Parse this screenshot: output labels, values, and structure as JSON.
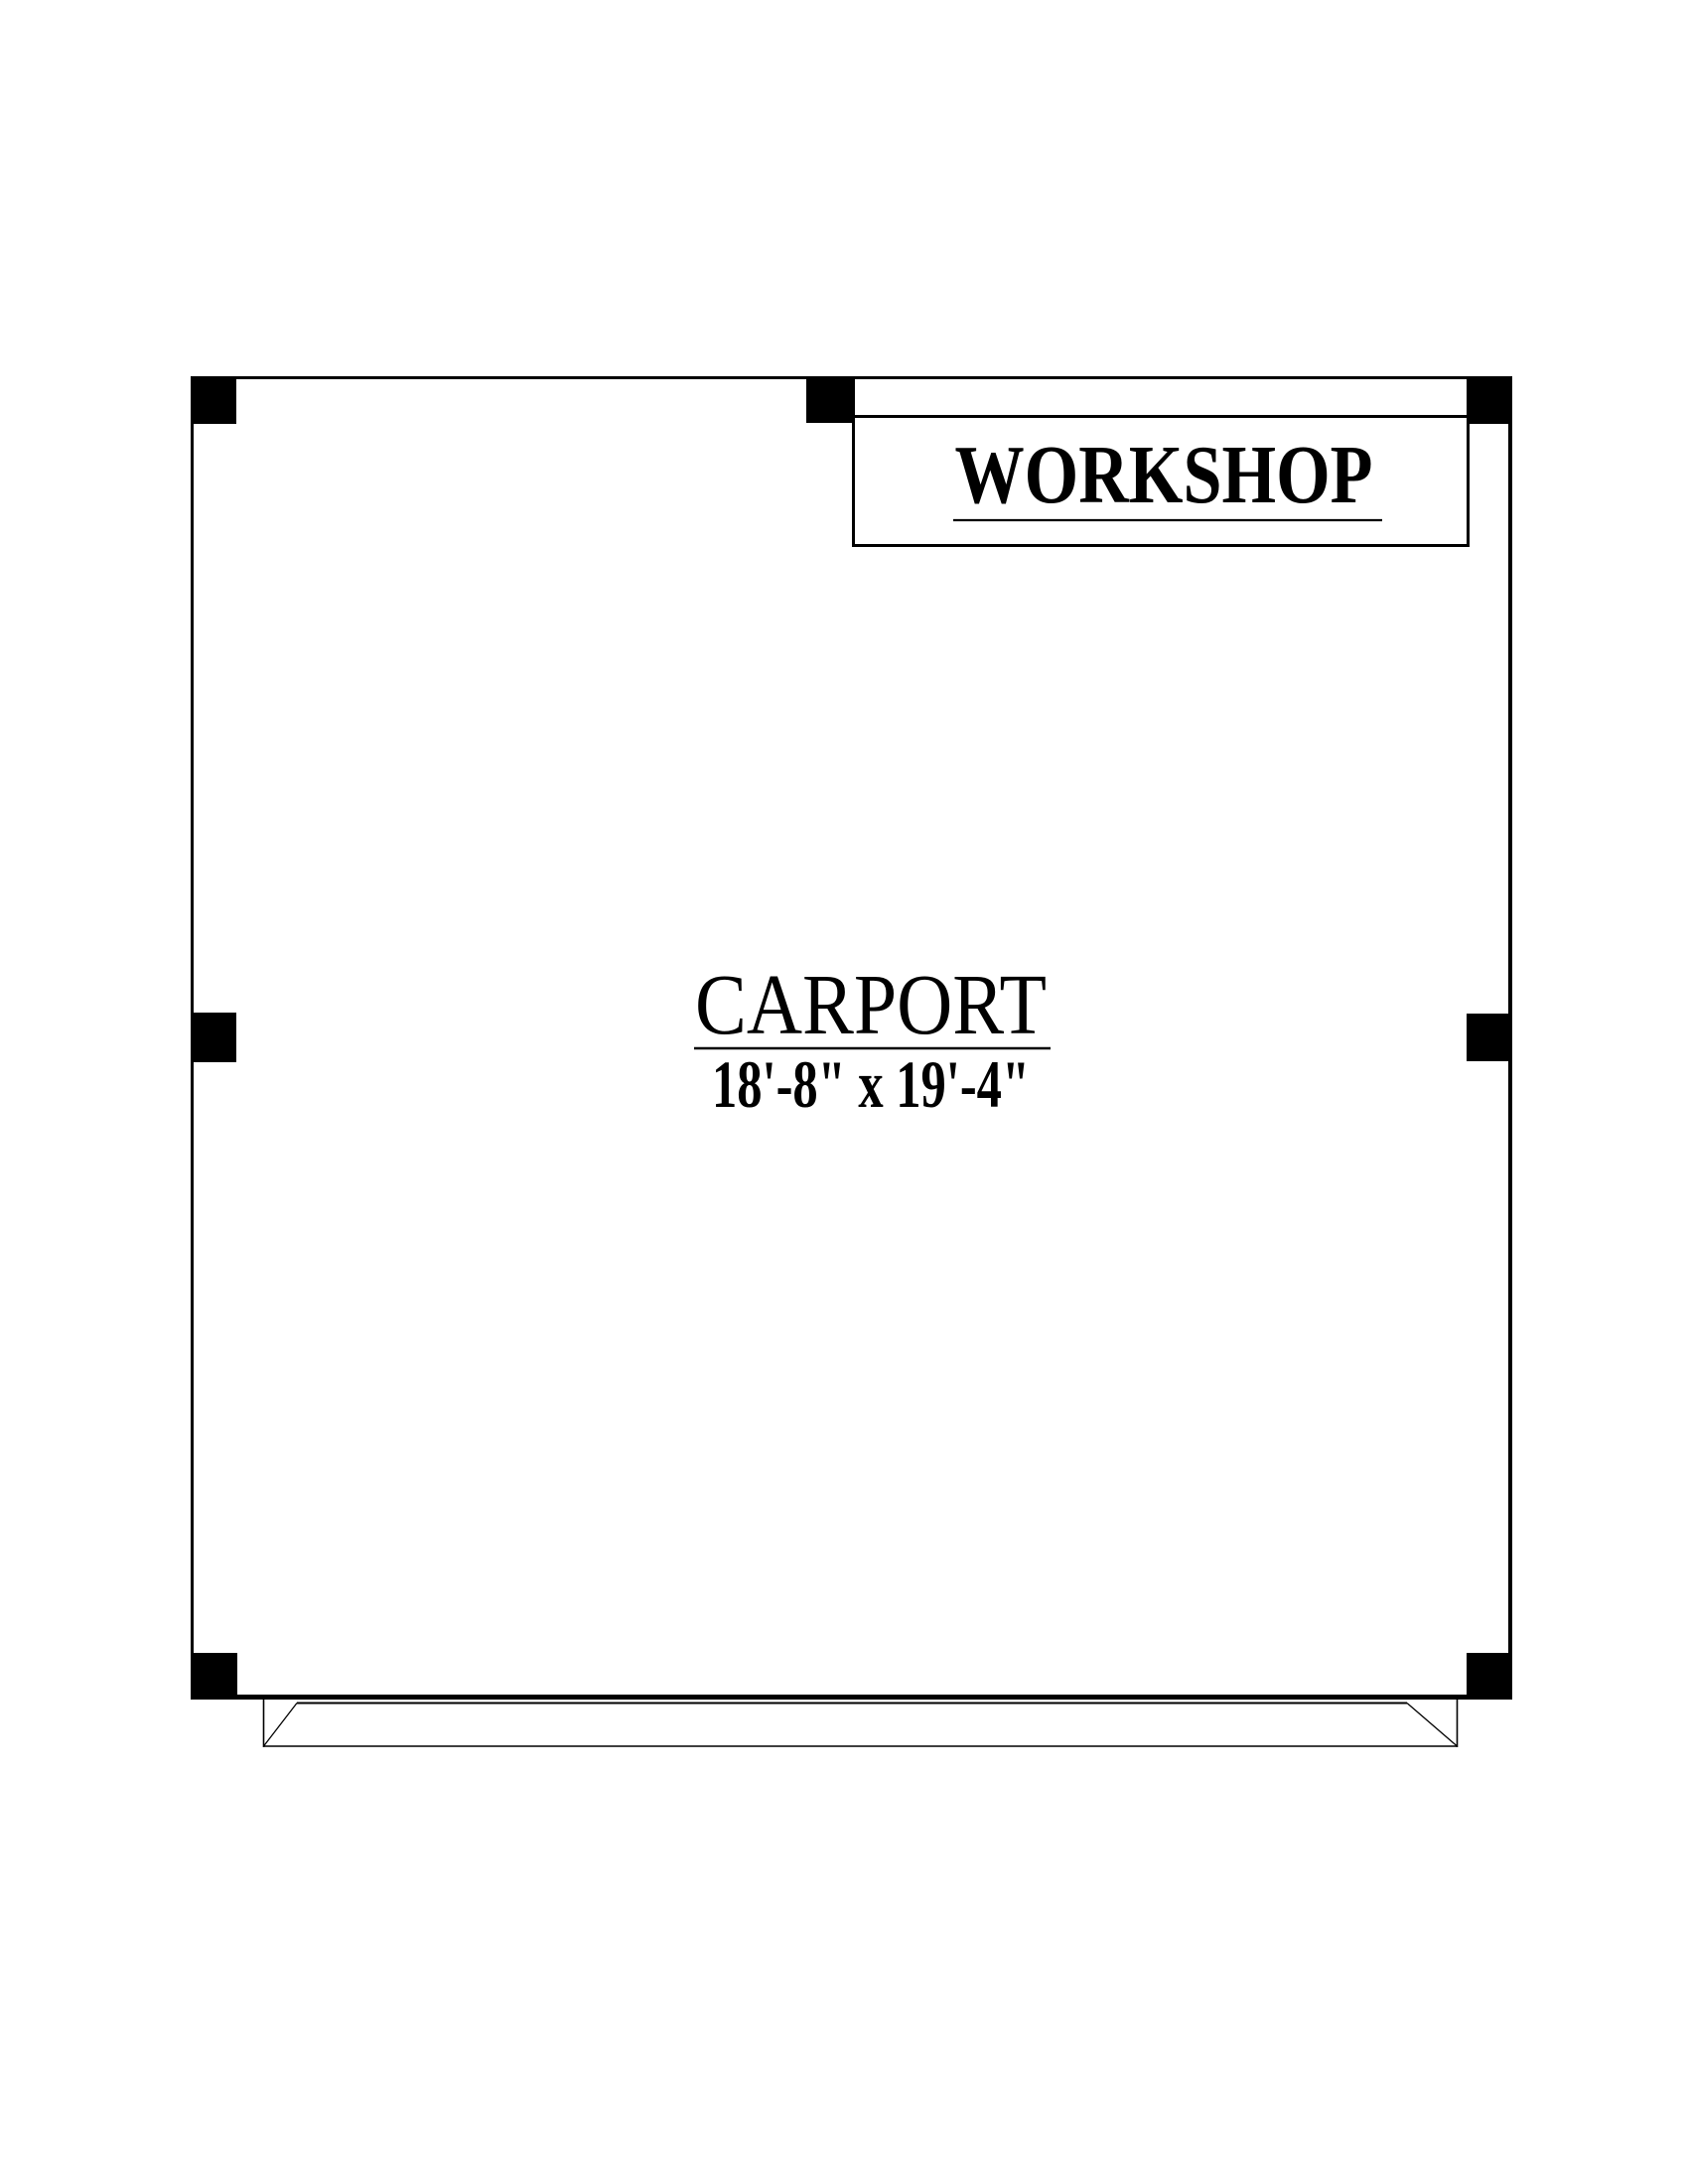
{
  "page": {
    "background_color": "#ffffff",
    "line_color": "#000000"
  },
  "workshop": {
    "label": "WORKSHOP"
  },
  "carport": {
    "label": "CARPORT",
    "dimensions": "18'-8\" x 19'-4\""
  }
}
